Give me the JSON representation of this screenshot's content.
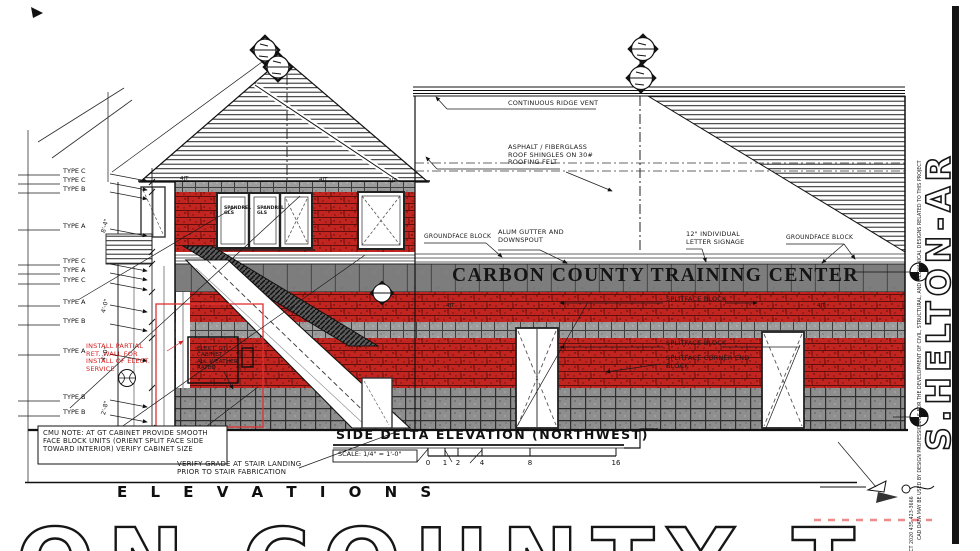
{
  "drawing": {
    "signage_text": "CARBON COUNTY TRAINING CENTER",
    "view_title": "SIDE DELTA ELEVATION (NORTHWEST)",
    "view_scale": "SCALE: 1/4\" = 1'-0\"",
    "scale_ticks": [
      "0",
      "1",
      "2",
      "4",
      "8",
      "16"
    ],
    "section_heading": "E L E V A T I O N S",
    "bottom_banner_text": "ON COUNTY TRA",
    "vertical_title": "S.HELTON-AR",
    "side_note_phone": "ACT 2020 435-423-3666",
    "side_note_legal": "CAD DATA MAY BE USED BY DESIGN PROFESSIONALS FOR THE DEVELOPMENT OF CIVIL, STRUCTURAL, AND MECHANICAL DESIGNS RELATED TO THIS PROJECT"
  },
  "annotations": {
    "ridge_vent": "CONTINUOUS RIDGE VENT",
    "shingles": "ASPHALT / FIBERGLASS\nROOF SHINGLES ON 30#\nROOFING FELT",
    "gutter": "ALUM GUTTER AND\nDOWNSPOUT",
    "signage_note": "12\" INDIVIDUAL\nLETTER SIGNAGE",
    "groundface_left": "GROUNDFACE BLOCK",
    "groundface_right": "GROUNDFACE BLOCK",
    "splitface_1": "SPLITFACE BLOCK",
    "splitface_2": "SPLITFACE BLOCK",
    "splitface_corner": "SPLITFACE CORNER END\nBLOCK",
    "install_note": "INSTALL PARTIAL\nRET. WALL FOR\nINSTALL OF ELECT.\nSERVICE",
    "cabinet_note": "ELECT. GT\nCABINET\nALL WEATHER\nRATED",
    "cmu_note": "CMU NOTE: AT GT CABINET PROVIDE SMOOTH\nFACE BLOCK UNITS (ORIENT SPLIT FACE SIDE\nTOWARD INTERIOR) VERIFY CABINET SIZE",
    "verify_grade": "VERIFY GRADE AT STAIR LANDING\nPRIOR TO STAIR FABRICATION",
    "joint_marker": "4JT",
    "glass_label": "SPANDREL\nGLS"
  },
  "type_labels": [
    "TYPE C",
    "TYPE C",
    "TYPE B",
    "TYPE A",
    "TYPE C",
    "TYPE A",
    "TYPE C",
    "TYPE A",
    "TYPE B",
    "TYPE A",
    "TYPE B",
    "TYPE B"
  ],
  "dimensions": [
    "8'-4\"",
    "4'-0\"",
    "4'-0\"",
    "2'-8\""
  ],
  "colors": {
    "brick_red": "#c22420",
    "block_gray": "#9c9c9c",
    "sign_gray": "#7d7d7d",
    "note_red": "#d42020",
    "dash_red": "#ef8a8a"
  }
}
